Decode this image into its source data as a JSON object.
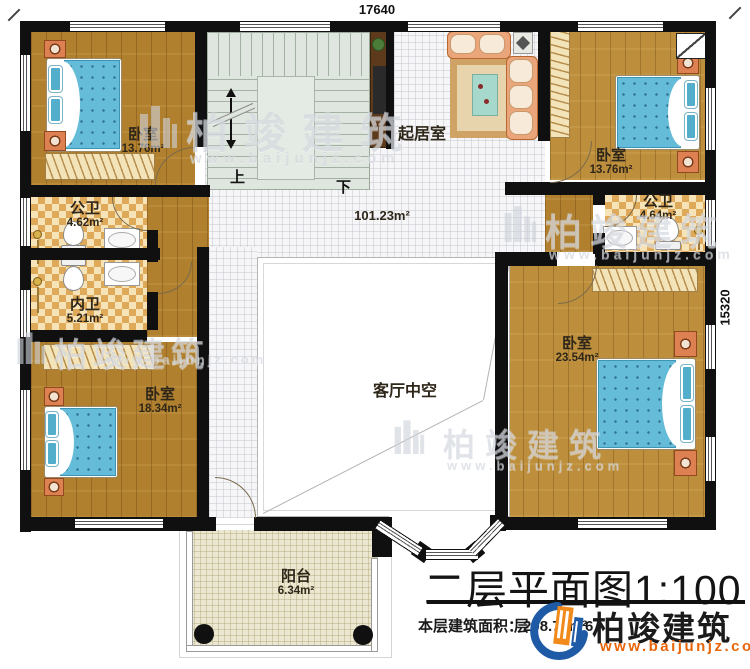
{
  "dimensions": {
    "top": "17640",
    "right": "15320"
  },
  "title_block": {
    "title": "二层平面图1:100",
    "area_label": "本层建筑面积：",
    "area_value": "208.77m²",
    "obscured_char": "层",
    "obscured_digit": "6"
  },
  "brand": {
    "name": "柏竣建筑",
    "url": "www.baijunjz.com",
    "blue": "#1e5aa6",
    "orange": "#f28a1b",
    "url_color": "#e8650a"
  },
  "watermark": {
    "name": "柏竣建筑",
    "url": "www.baijunjz.com"
  },
  "rooms": {
    "bedroom_top_left": {
      "name": "卧室",
      "area": "13.76m²"
    },
    "bedroom_top_right": {
      "name": "卧室",
      "area": "13.76m²"
    },
    "bedroom_bottom_left": {
      "name": "卧室",
      "area": "18.34m²"
    },
    "bedroom_bottom_right": {
      "name": "卧室",
      "area": "23.54m²"
    },
    "bath_public_left": {
      "name": "公卫",
      "area": "4.62m²"
    },
    "bath_inner_left": {
      "name": "内卫",
      "area": "5.21m²"
    },
    "bath_public_right": {
      "name": "公卫",
      "area": "4.64m²"
    },
    "living_room": {
      "name": "起居室"
    },
    "hall": {
      "area": "101.23m²"
    },
    "void": {
      "name": "客厅中空"
    },
    "balcony": {
      "name": "阳台",
      "area": "6.34m²"
    },
    "stairs": {
      "up": "上",
      "down": "下"
    }
  }
}
